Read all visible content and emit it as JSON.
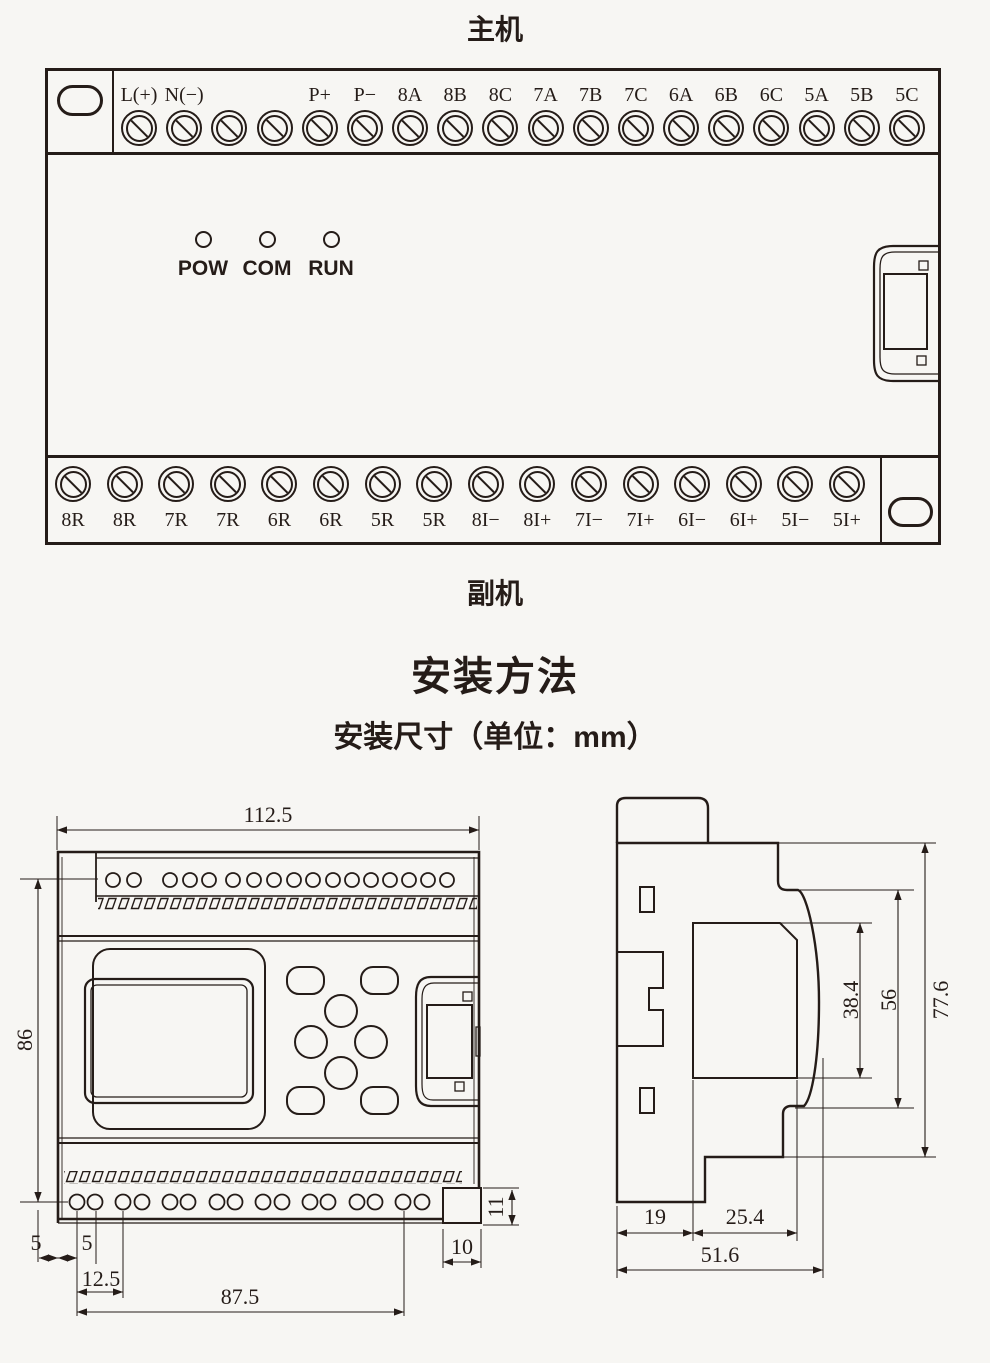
{
  "colors": {
    "ink": "#251c18",
    "background": "#f7f6f3"
  },
  "main_unit": {
    "title": "主机",
    "top_terminals": [
      "L(+)",
      "N(−)",
      "",
      "",
      "P+",
      "P−",
      "8A",
      "8B",
      "8C",
      "7A",
      "7B",
      "7C",
      "6A",
      "6B",
      "6C",
      "5A",
      "5B",
      "5C"
    ],
    "status_leds": [
      "POW",
      "COM",
      "RUN"
    ],
    "bottom_terminals": [
      "8R",
      "8R",
      "7R",
      "7R",
      "6R",
      "6R",
      "5R",
      "5R",
      "8I−",
      "8I+",
      "7I−",
      "7I+",
      "6I−",
      "6I+",
      "5I−",
      "5I+"
    ]
  },
  "secondary_unit_label": "副机",
  "installation": {
    "title": "安装方法",
    "subtitle": "安装尺寸（单位：mm）"
  },
  "front_view": {
    "dim_width": "112.5",
    "dim_height": "86",
    "dim_left_edge": "5",
    "dim_first_hole": "5",
    "dim_hole_pair": "12.5",
    "dim_hole_span": "87.5",
    "dim_notch_width": "10",
    "dim_notch_height": "11"
  },
  "side_view": {
    "dim_recess": "38.4",
    "dim_step": "56",
    "dim_height": "77.6",
    "dim_rail": "19",
    "dim_front": "25.4",
    "dim_depth": "51.6"
  }
}
